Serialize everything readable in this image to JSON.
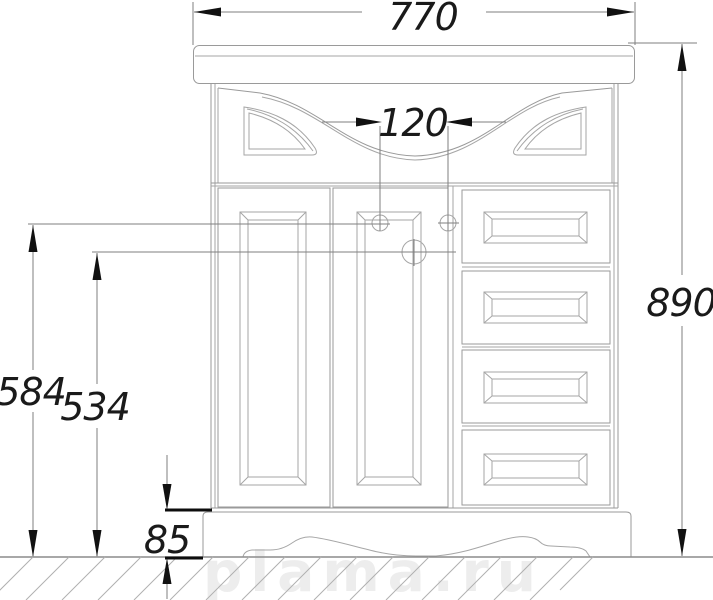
{
  "drawing": {
    "watermark": "plama.ru",
    "dimensions": {
      "top_width": "770",
      "handle_spacing": "120",
      "overall_height": "890",
      "upper_knob_height": "584",
      "lower_knob_height": "534",
      "plinth_height": "85"
    },
    "colors": {
      "background": "#ffffff",
      "cabinet_outline": "#9a9a9a",
      "dimension_line": "#7f7f7f",
      "dimension_text": "#1a1a1a",
      "arrow": "#111111",
      "ground_hatch": "#b0b0b0",
      "watermark": "#ededed"
    }
  }
}
